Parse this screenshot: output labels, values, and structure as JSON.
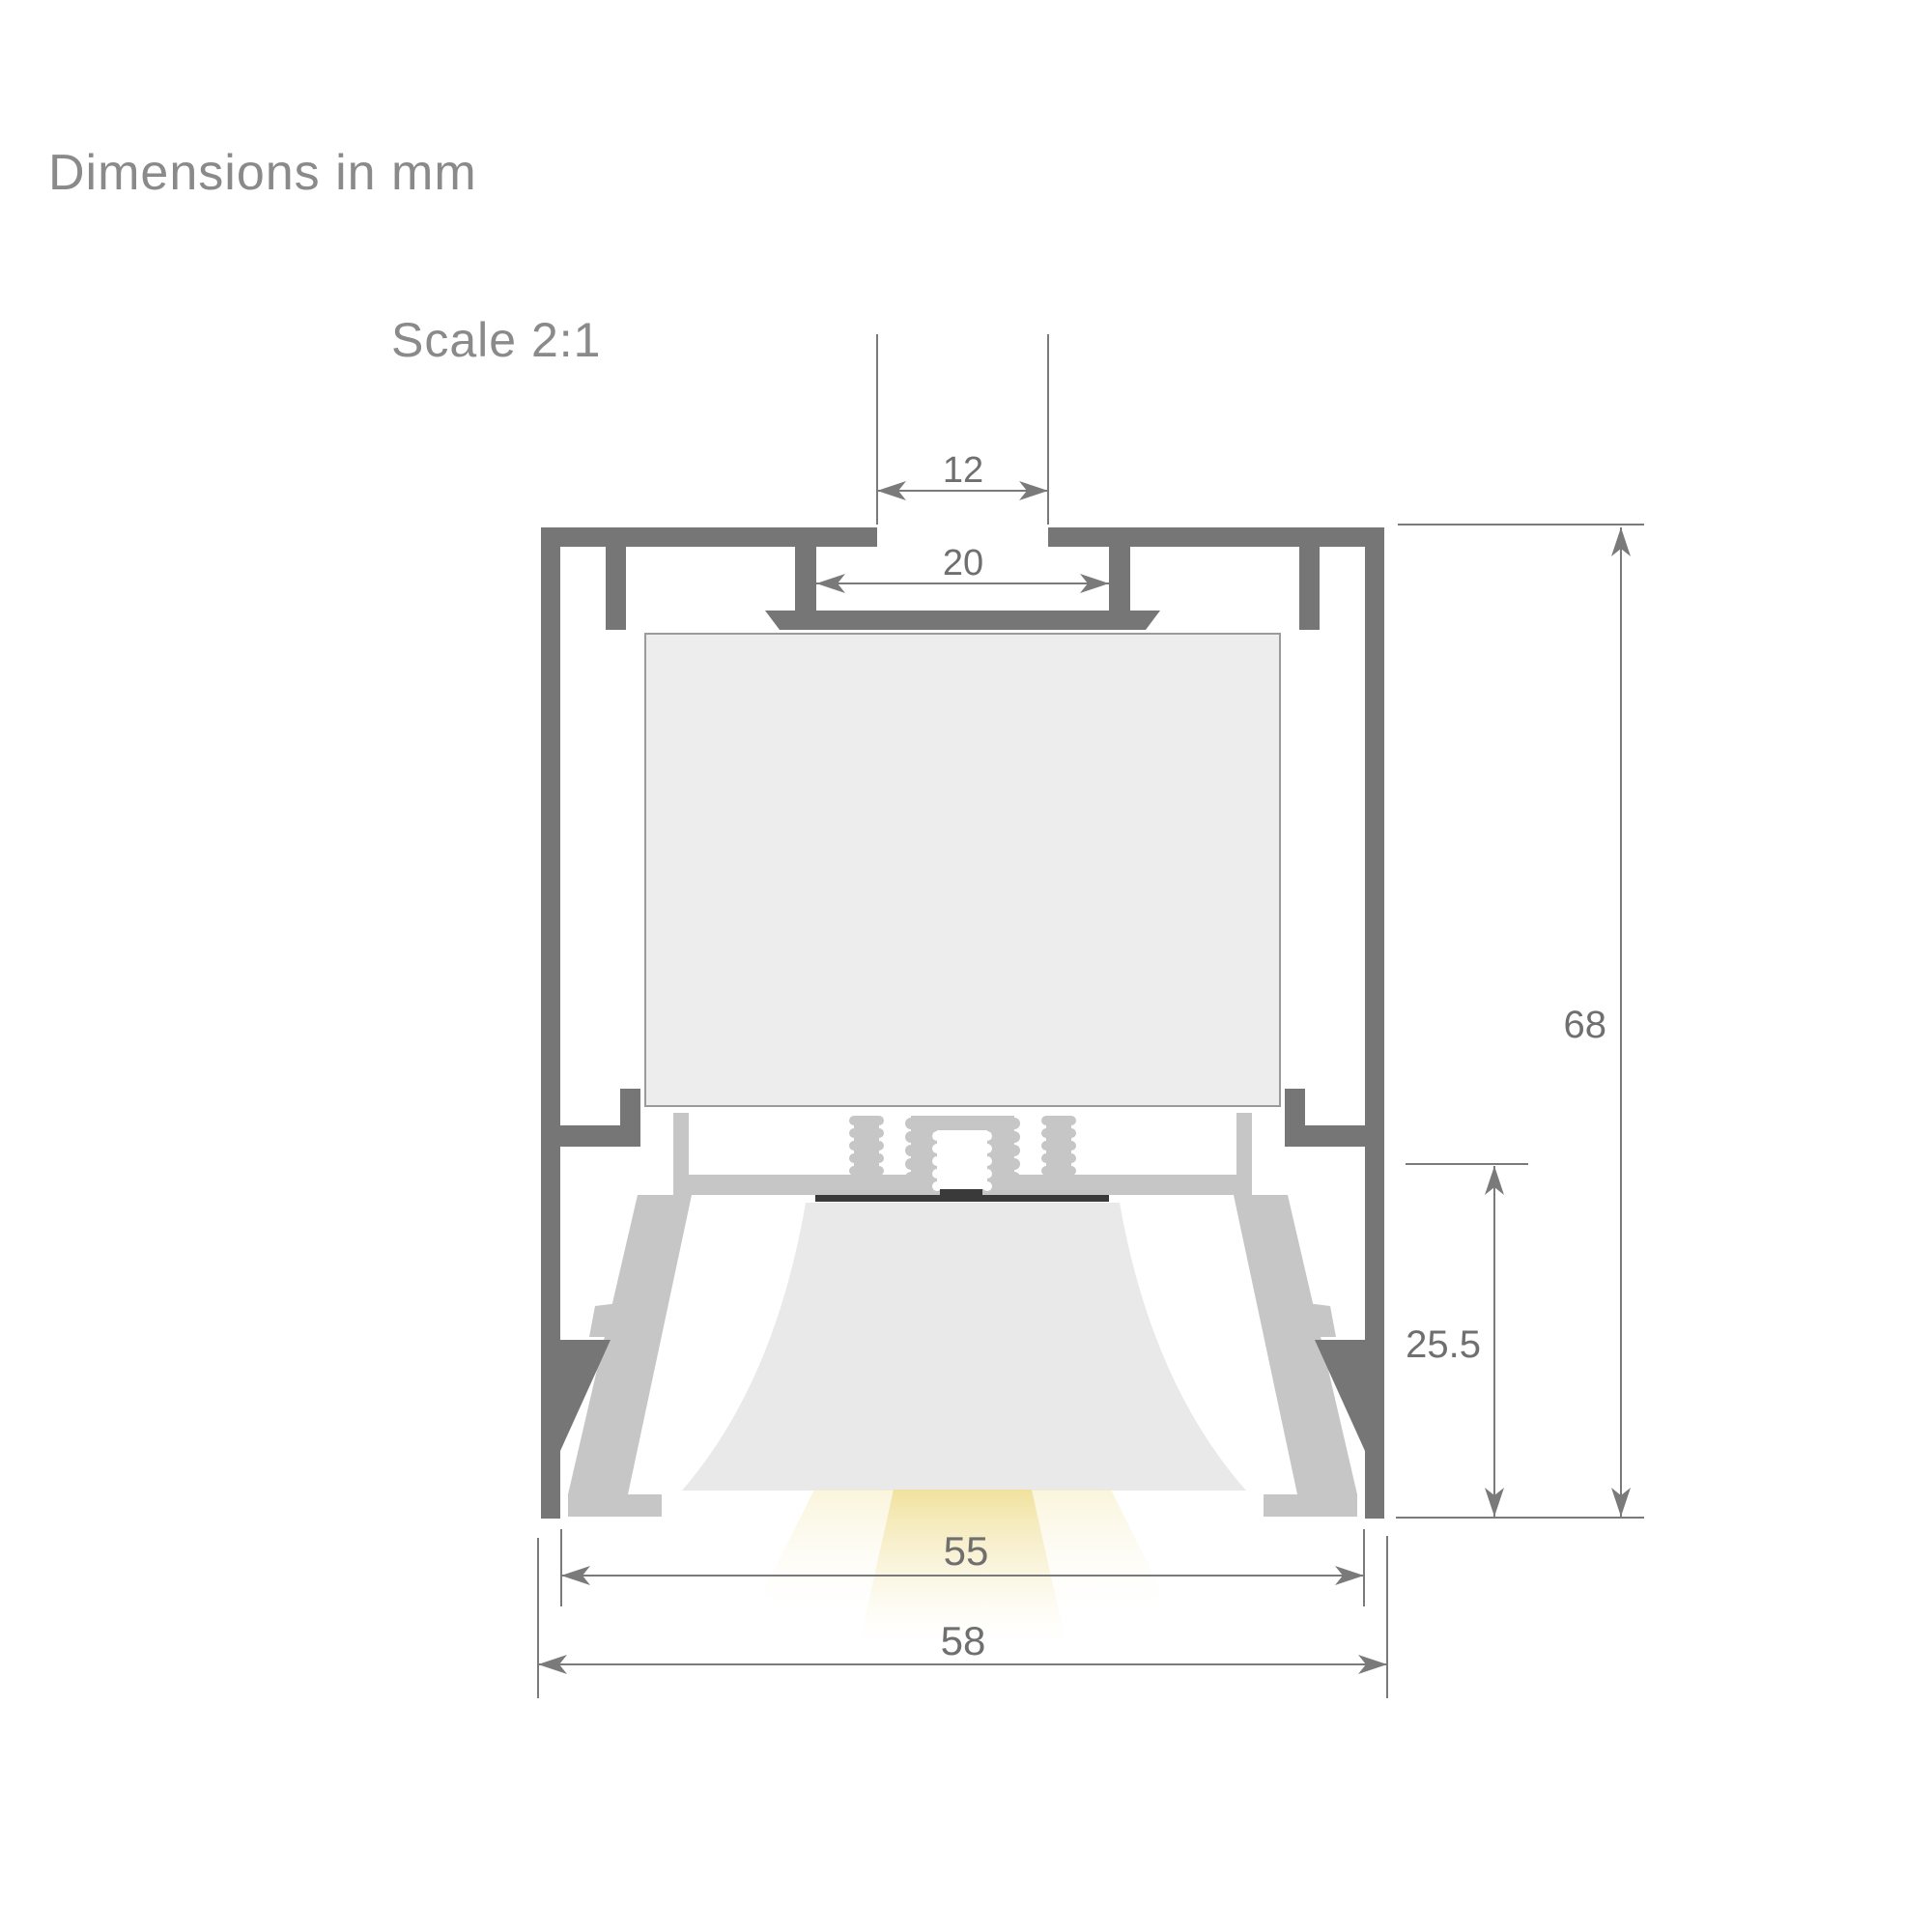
{
  "page": {
    "title": "Dimensions in mm",
    "scale_label": "Scale 2:1"
  },
  "drawing": {
    "type": "LED aluminium profile cross-section",
    "units": "mm",
    "scale": "2:1"
  },
  "dimensions": {
    "top_slot_opening": "12",
    "top_slot_inner_width": "20",
    "overall_height": "68",
    "lower_section_height": "25.5",
    "inner_width": "55",
    "overall_width": "58"
  },
  "colors": {
    "profile_dark": "#767676",
    "hardware_silver": "#c6c6c6",
    "cavity_fill": "#ededed",
    "cavity_border": "#9b9b9b",
    "beam_fill": "#e9e9e9",
    "led_bar": "#3a3a3a",
    "dimension_lines": "#7a7a7a",
    "dimension_text": "#6f6f6f",
    "title_text": "#8a8a8a",
    "glow_warm": "#f2e2a0"
  }
}
